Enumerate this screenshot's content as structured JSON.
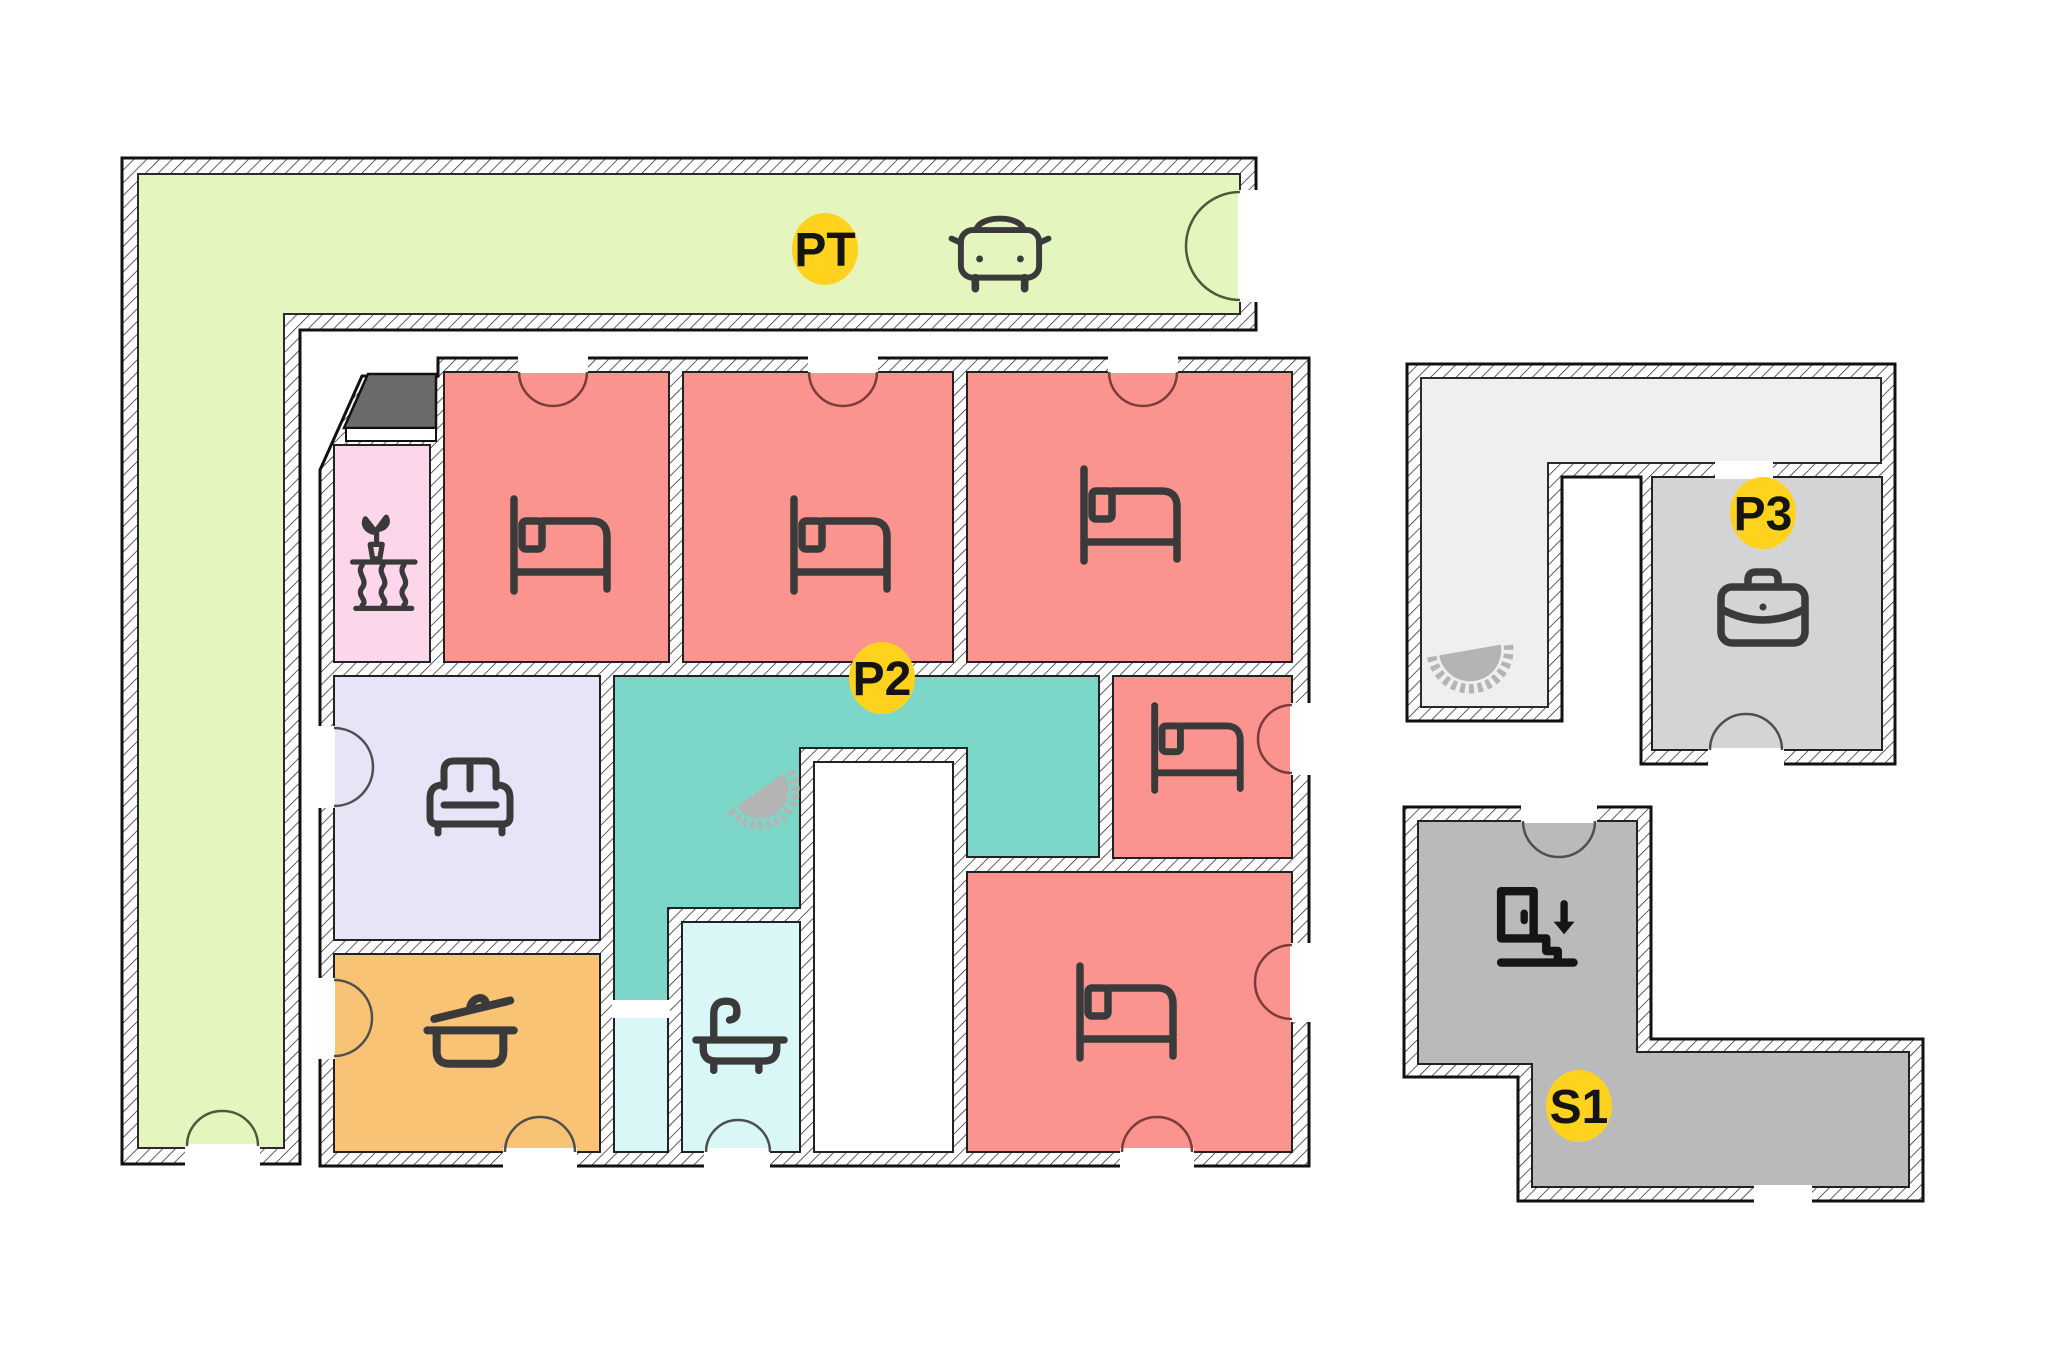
{
  "plan": {
    "type": "architectural floor plan",
    "background": "#ffffff"
  },
  "badges": {
    "parking": "PT",
    "apartment": "P2",
    "office": "P3",
    "stairwell": "S1"
  },
  "colors": {
    "parking_area": "#e4f6bd",
    "bedroom": "#fb938e",
    "winter_garden": "#fcd7ec",
    "living_room": "#e8e3f6",
    "kitchen": "#f9c376",
    "corridor": "#7cd7c8",
    "bathroom": "#d9f7f6",
    "utility_strip": "#d9f7f6",
    "balcony": "#6b6b6b",
    "office_corridor": "#efefef",
    "office_room": "#d4d4d4",
    "stairwell_area": "#bababa",
    "courtyard": "#ffffff",
    "badge": "#ffd21e",
    "wall_line": "#111111",
    "icon_stroke": "#3a3a3a",
    "stair_fan": "#b4b4b4",
    "door_arc_bedroom": "#7a3c3c",
    "door_arc_neutral": "#4f4f4f",
    "door_arc_parking": "#4c5a3c"
  },
  "icons": {
    "car": "car-icon",
    "bed": "bed-icon",
    "plant_table": "plant-table-icon",
    "sofa": "sofa-icon",
    "cooking_pot": "cooking-pot-icon",
    "bathtub": "bathtub-icon",
    "briefcase": "briefcase-icon",
    "stairs_down": "stairs-down-icon",
    "spiral_stair_fan": "spiral-stair-fan-icon"
  }
}
